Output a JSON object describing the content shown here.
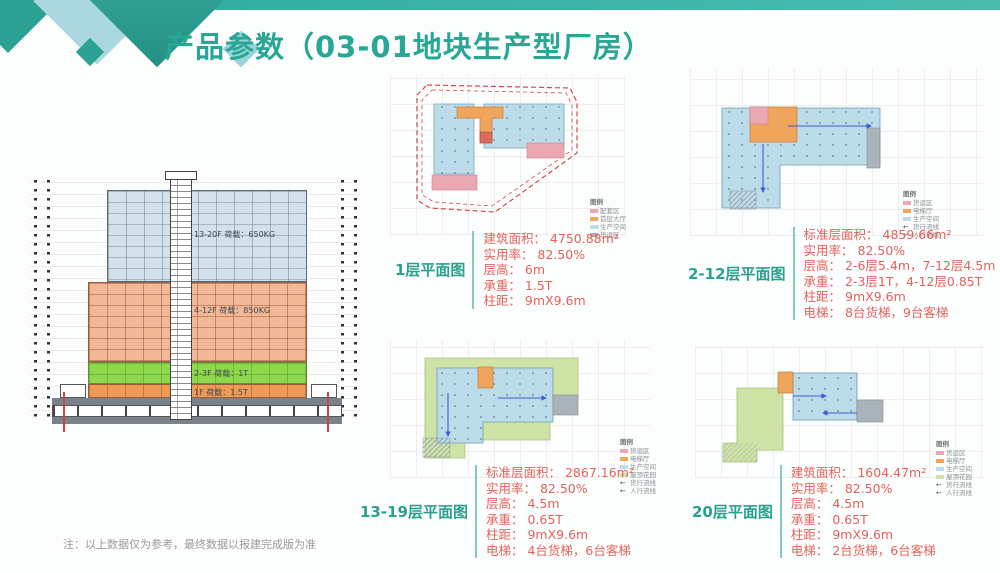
{
  "header": {
    "title": "产品参数（03-01地块生产型厂房）"
  },
  "elevation": {
    "bands": [
      {
        "label": "13-20F 荷载：650KG"
      },
      {
        "label": "4-12F 荷载：850KG"
      },
      {
        "label": "2-3F 荷载：1T"
      },
      {
        "label": "1F 荷载：1.5T"
      }
    ]
  },
  "plans": [
    {
      "label": "1层平面图",
      "specs": [
        "建筑面积： 4750.88m²",
        "实用率： 82.50%",
        "层高： 6m",
        "承重： 1.5T",
        "柱距： 9mX9.6m"
      ],
      "legend": {
        "title": "图例",
        "items": [
          "配套区",
          "首层大厅",
          "生产空间",
          "货运区"
        ]
      }
    },
    {
      "label": "2-12层平面图",
      "specs": [
        "标准层面积： 4859.66m²",
        "实用率： 82.50%",
        "层高： 2-6层5.4m，7-12层4.5m",
        "承重： 2-3层1T，4-12层0.85T",
        "柱距： 9mX9.6m",
        "电梯： 8台货梯，9台客梯"
      ],
      "legend": {
        "title": "图例",
        "items": [
          "货运区",
          "电梯厅",
          "生产空间",
          "货行流线",
          "人行流线"
        ]
      }
    },
    {
      "label": "13-19层平面图",
      "specs": [
        "标准层面积： 2867.16m²",
        "实用率： 82.50%",
        "层高： 4.5m",
        "承重： 0.65T",
        "柱距： 9mX9.6m",
        "电梯： 4台货梯，6台客梯"
      ],
      "legend": {
        "title": "图例",
        "items": [
          "货运区",
          "电梯厅",
          "生产空间",
          "屋顶花园",
          "货行流线",
          "人行流线"
        ]
      }
    },
    {
      "label": "20层平面图",
      "specs": [
        "建筑面积： 1604.47m²",
        "实用率： 82.50%",
        "层高： 4.5m",
        "承重： 0.65T",
        "柱距： 9mX9.6m",
        "电梯： 2台货梯，6台客梯"
      ],
      "legend": {
        "title": "图例",
        "items": [
          "货运区",
          "电梯厅",
          "生产空间",
          "屋顶花园",
          "货行流线",
          "人行流线"
        ]
      }
    }
  ],
  "note": "注：以上数据仅为参考，最终数据以报建完成版为准",
  "icons": {
    "flow_arrow": "←"
  },
  "colors": {
    "accent": "#27a794",
    "spec_text": "#e2635c",
    "plan_blue": "#bcdcea",
    "plan_orange": "#f0a55c",
    "plan_pink": "#eaa9b2",
    "plan_green": "#cfe3a6",
    "plan_gray": "#aab3b9",
    "elev_blue": "#d3e2ea",
    "elev_orange": "#f3b895",
    "elev_green": "#8ed84e",
    "elev_orange2": "#f09b55"
  }
}
